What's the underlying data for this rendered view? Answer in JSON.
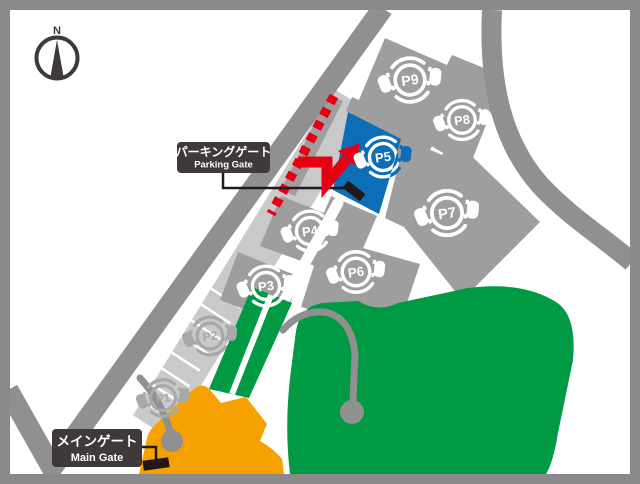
{
  "map": {
    "compass": {
      "label": "N"
    },
    "gate_labels": {
      "parking_gate": {
        "ja": "パーキングゲート",
        "en": "Parking Gate"
      },
      "main_gate": {
        "ja": "メインゲート",
        "en": "Main Gate"
      }
    },
    "parking_lots": [
      {
        "id": "p1",
        "label": "P1",
        "x": 163,
        "y": 398,
        "icon_color": "#a8a8a8",
        "scale": 0.92
      },
      {
        "id": "p2",
        "label": "P2",
        "x": 210,
        "y": 336,
        "icon_color": "#a8a8a8",
        "scale": 0.95
      },
      {
        "id": "p3",
        "label": "P3",
        "x": 266,
        "y": 286,
        "icon_color": "#ffffff",
        "scale": 1.0
      },
      {
        "id": "p4",
        "label": "P4",
        "x": 310,
        "y": 231,
        "icon_color": "#ffffff",
        "scale": 1.0
      },
      {
        "id": "p5",
        "label": "P5",
        "x": 383,
        "y": 157,
        "icon_color": "#ffffff",
        "scale": 1.0,
        "highlight": true,
        "highlight_color": "#0d6db7"
      },
      {
        "id": "p6",
        "label": "P6",
        "x": 356,
        "y": 272,
        "icon_color": "#ffffff",
        "scale": 1.02
      },
      {
        "id": "p7",
        "label": "P7",
        "x": 447,
        "y": 213,
        "icon_color": "#ffffff",
        "scale": 1.12
      },
      {
        "id": "p8",
        "label": "P8",
        "x": 462,
        "y": 120,
        "icon_color": "#ffffff",
        "scale": 0.98
      },
      {
        "id": "p9",
        "label": "P9",
        "x": 410,
        "y": 80,
        "icon_color": "#ffffff",
        "scale": 1.1
      }
    ],
    "colors": {
      "frame": "#8a8a8a",
      "road": "#909090",
      "lot": "#9e9e9e",
      "strip": "#c9c9c9",
      "green": "#009944",
      "orange": "#f5a200",
      "highlight_blue": "#0d6db7",
      "route_red": "#e60012",
      "label_bg": "#3e3a39",
      "ink": "#231815"
    }
  }
}
